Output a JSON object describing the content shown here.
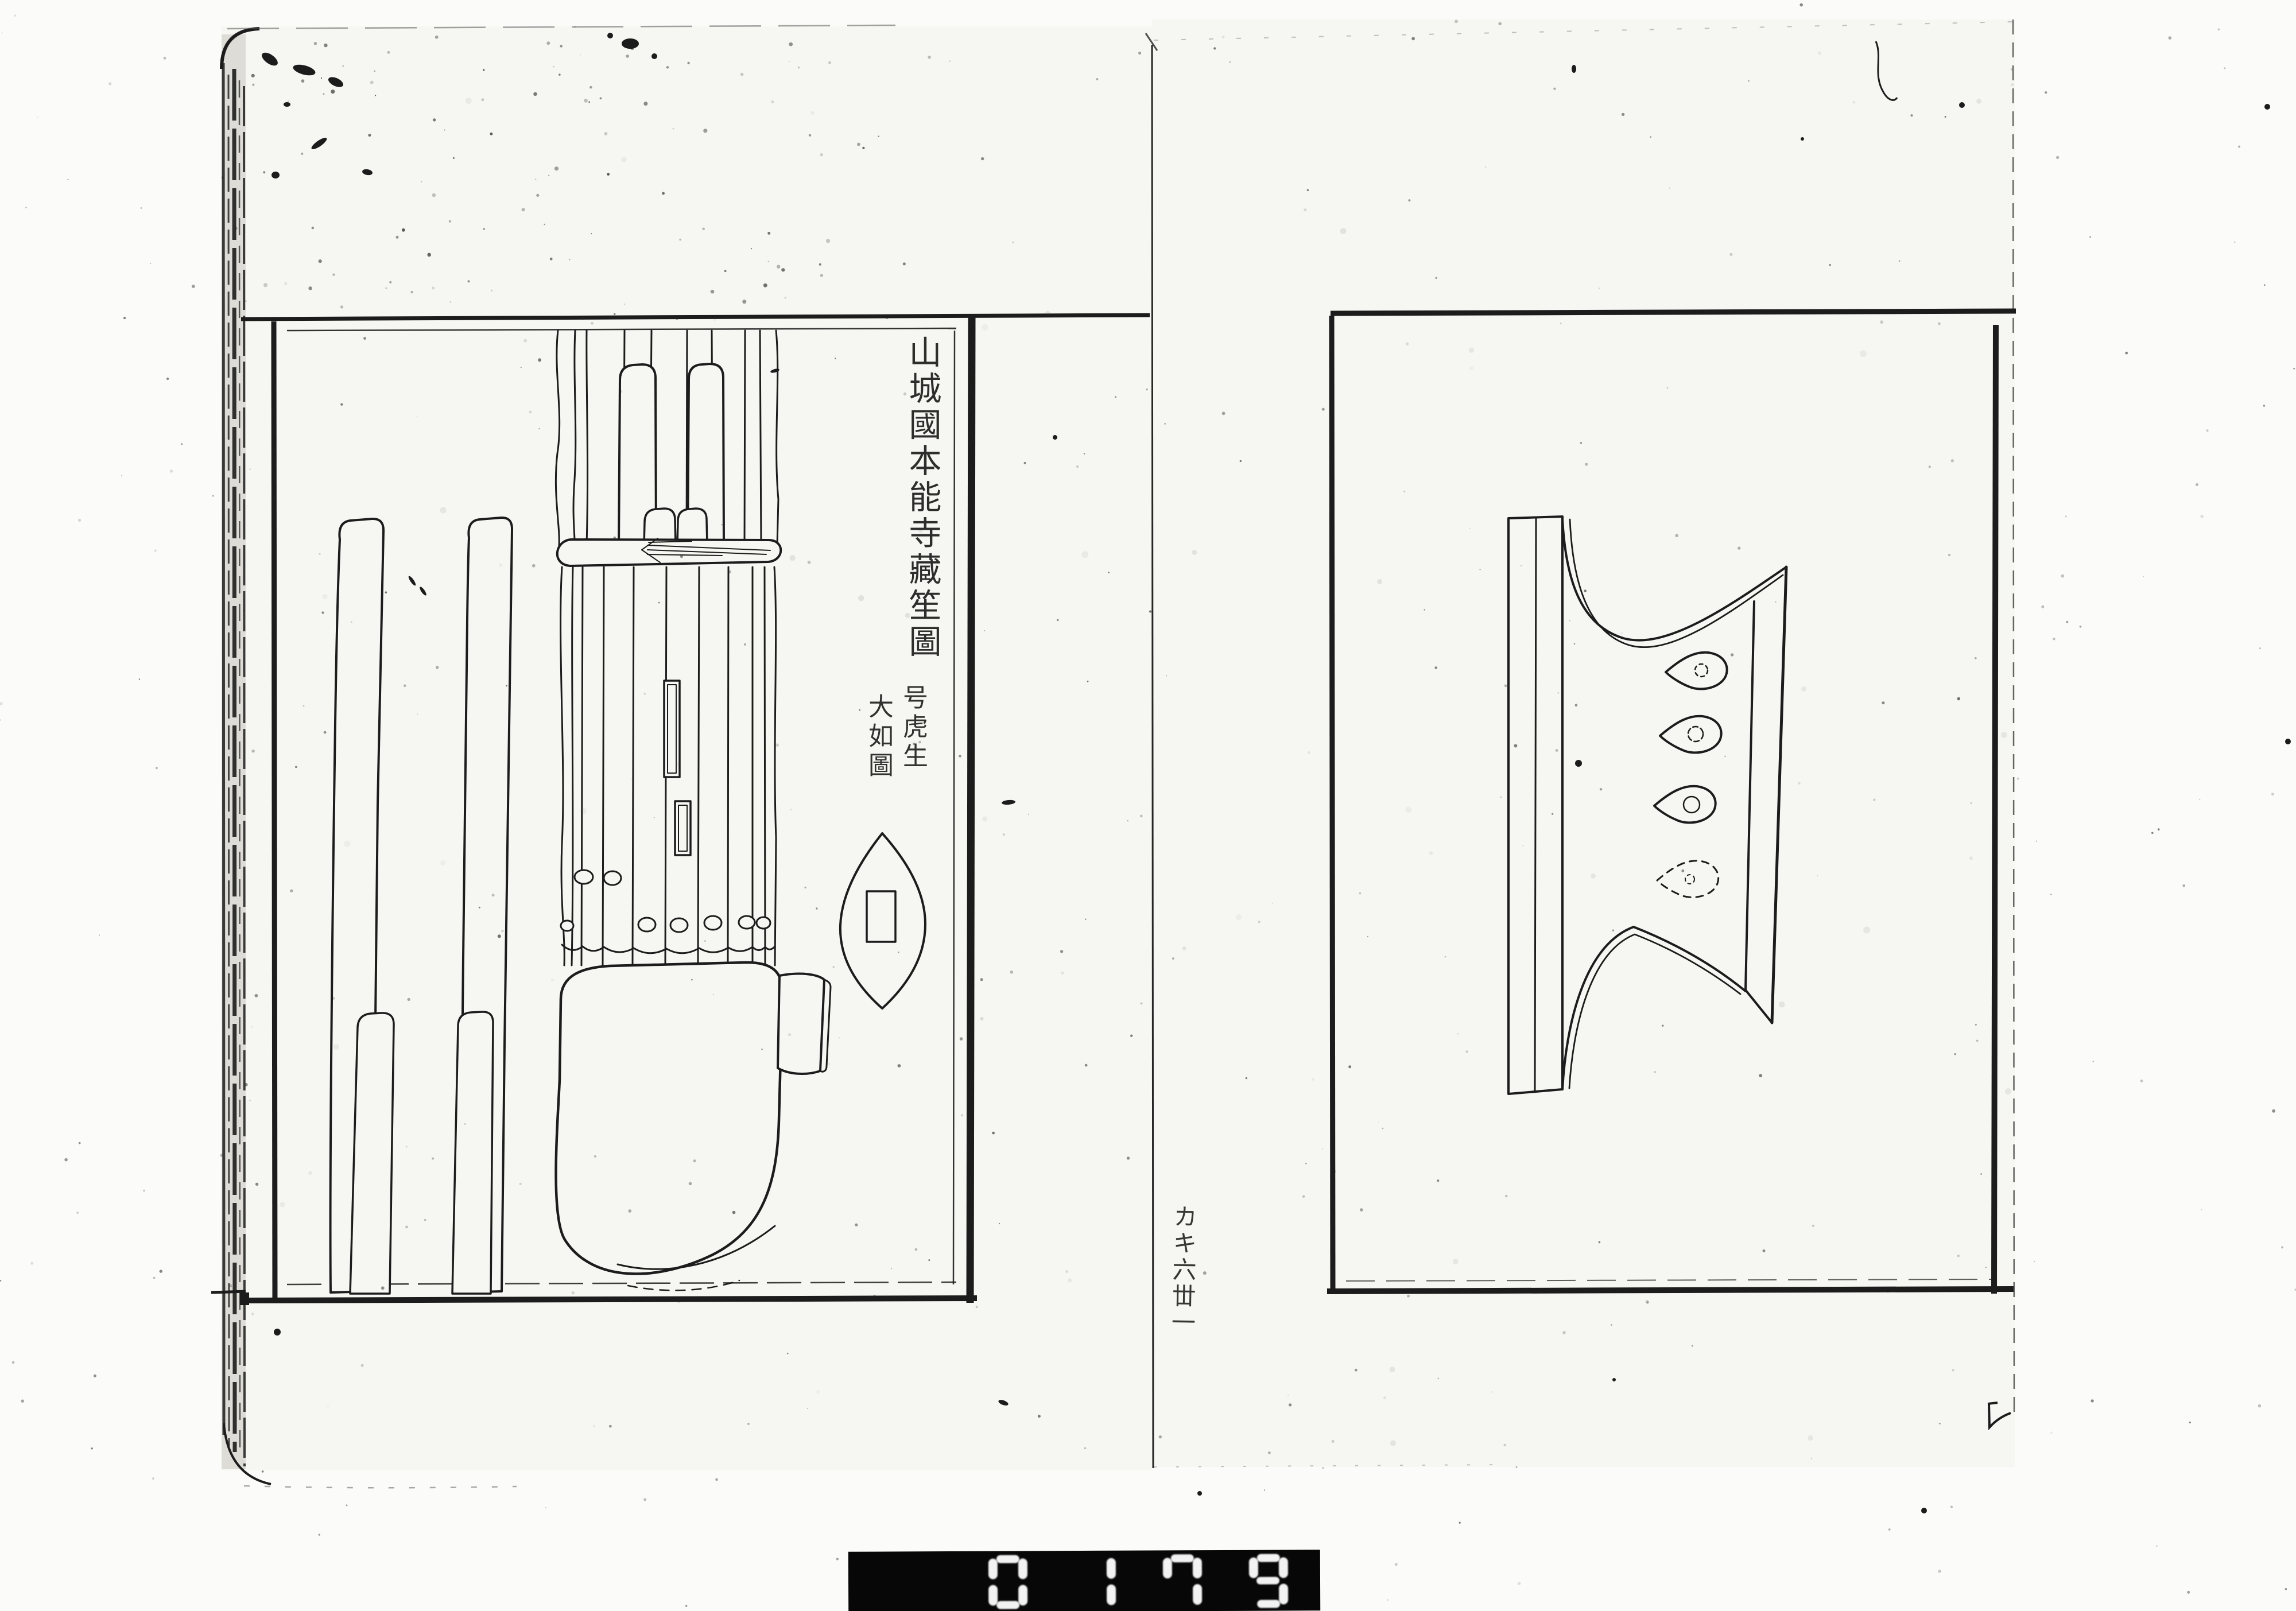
{
  "page": {
    "paper_color": "#f6f6f2",
    "ink_color": "#1c1c1c"
  },
  "left_page": {
    "title": "山城國本能寺藏笙圖",
    "annotations": [
      "号虎生",
      "大如圖"
    ],
    "illustration": "sho-mouth-organ-drawing"
  },
  "right_page": {
    "illustration": "sho-wind-chamber-drawing"
  },
  "gutter": {
    "note": "カキ六丗一"
  },
  "counter": {
    "value": "0179",
    "background": "#070707",
    "digit_color": "#ffffff"
  }
}
